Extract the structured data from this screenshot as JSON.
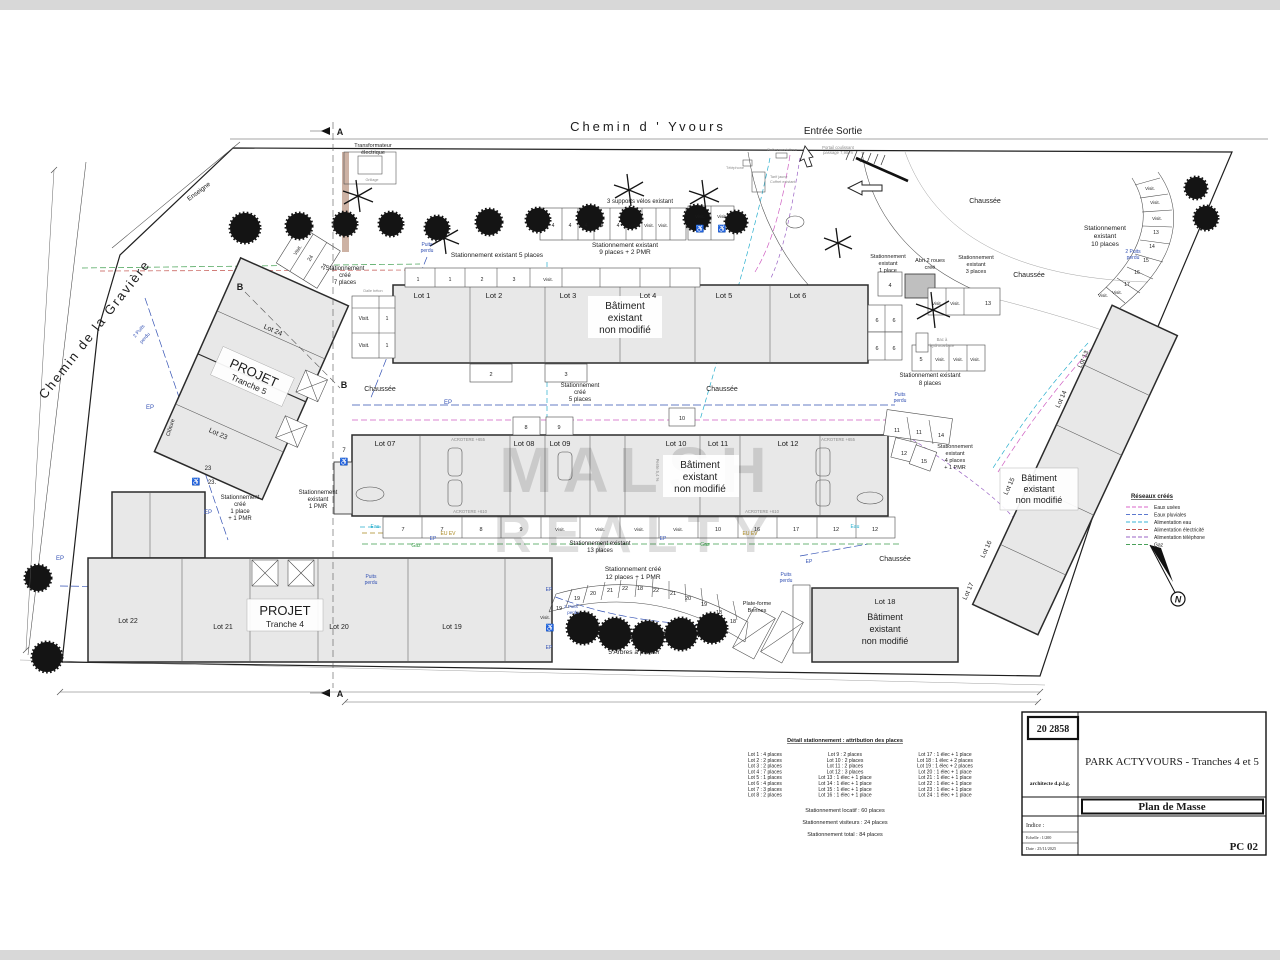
{
  "streets": {
    "top": "Chemin  d ' Yvours",
    "left": "Chemin de la Gravière"
  },
  "entrance": {
    "label": "Entrée Sortie",
    "gate1": "Portail coulissant",
    "gate2": "passage 7,90 m"
  },
  "transformer": {
    "l1": "Transformateur",
    "l2": "électrique",
    "cage": "Grillage"
  },
  "sections": {
    "a": "A",
    "b": "B"
  },
  "north": {
    "label": "N"
  },
  "watermark": {
    "l1": "MALSH",
    "l2": "REALTY"
  },
  "legend": {
    "title": "Réseaux créés",
    "items": [
      {
        "label": "Eaux usées",
        "color": "#d966c9"
      },
      {
        "label": "Eaux pluviales",
        "color": "#5c79cf"
      },
      {
        "label": "Alimentation eau",
        "color": "#38b3d6"
      },
      {
        "label": "Alimentation électricité",
        "color": "#c2524c"
      },
      {
        "label": "Alimentation téléphone",
        "color": "#9a63c4"
      },
      {
        "label": "Gaz",
        "color": "#4aa05a"
      }
    ]
  },
  "buildings": {
    "b1": {
      "l1": "Bâtiment",
      "l2": "existant",
      "l3": "non modifié",
      "lots": [
        "Lot 1",
        "Lot 2",
        "Lot 3",
        "Lot 4",
        "Lot 5",
        "Lot 6"
      ]
    },
    "b2": {
      "l1": "Bâtiment",
      "l2": "existant",
      "l3": "non modifié",
      "lots": [
        "Lot 07",
        "Lot 08",
        "Lot 09",
        "Lot 10",
        "Lot 11",
        "Lot 12"
      ]
    },
    "b3": {
      "l1": "Bâtiment",
      "l2": "existant",
      "l3": "non modifié",
      "lots": [
        "Lot 13",
        "Lot 14",
        "Lot 15",
        "Lot 16",
        "Lot 17"
      ]
    },
    "lot18": {
      "lot": "Lot 18",
      "l1": "Bâtiment",
      "l2": "existant",
      "l3": "non modifié"
    },
    "t5": {
      "name": "PROJET",
      "tranche": "Tranche 5",
      "lots": [
        "Lot 24",
        "Lot 23"
      ]
    },
    "t4": {
      "name": "PROJET",
      "tranche": "Tranche 4",
      "lots": [
        "Lot 22",
        "Lot 21",
        "Lot 20",
        "Lot 19"
      ]
    }
  },
  "parking": {
    "ex9": [
      "Stationnement existant",
      "9 places + 2 PMR"
    ],
    "ex5": "Stationnement existant  5 places",
    "cr7": [
      "Stationnement",
      "créé",
      "7 places"
    ],
    "cr5": [
      "Stationnement",
      "créé",
      "5 places"
    ],
    "ex13": [
      "Stationnement existant",
      "13 places"
    ],
    "cr12": [
      "Stationnement créé",
      "12 places + 1 PMR"
    ],
    "ex10": [
      "Stationnement",
      "existant",
      "10 places"
    ],
    "ex8": [
      "Stationnement existant",
      "8 places"
    ],
    "ex4": [
      "Stationnement",
      "existant",
      "4 places",
      "+ 1 PMR"
    ],
    "ex1": [
      "Stationnement",
      "existant",
      "1 place"
    ],
    "ex3": [
      "Stationnement",
      "existant",
      "3 places"
    ],
    "cr1": [
      "Stationnement",
      "créé",
      "1 place",
      "+ 1 PMR"
    ],
    "expmr": [
      "Stationnement",
      "existant",
      "1 PMR"
    ]
  },
  "features": {
    "abri": [
      "Abri 2 roues",
      "créé"
    ],
    "bac": [
      "Bac à",
      "hydrocarbure"
    ],
    "bennes": [
      "Plate-forme",
      "Bennes"
    ],
    "arbres": "5 Arbres à planter",
    "velos": "3 supports vélos existant",
    "chaussee": "Chaussée",
    "cloture": "Clôture",
    "enseigne": "Enseigne",
    "dalle": "Dalle béton",
    "pente": "Pente 5,4 %",
    "telephone": "Téléphone",
    "lettres": "Boîtes aux lettres",
    "coffret1": "Tarif jaune",
    "coffret2": "Coffret existant"
  },
  "utilities": {
    "ep": "EP",
    "eau": "Eau",
    "gaz": "Gaz",
    "euev": "EU EV",
    "puits1": "Puits",
    "puits2": "perdu",
    "p2a": "2 Puits",
    "acro655": "ACROTERE +655",
    "acro610": "ACROTERE +610"
  },
  "stalls": {
    "toprow": [
      "4",
      "4",
      "4",
      "4",
      "4",
      "Visit.",
      "Visit.",
      "Visit."
    ],
    "toppmr": [
      "Visit.",
      "Visit."
    ],
    "b1row": [
      "1",
      "1",
      "2",
      "3",
      "Visit."
    ],
    "b1below": [
      "2",
      "3"
    ],
    "vtable": [
      "Visit.",
      "1",
      "Visit.",
      "1"
    ],
    "left24": [
      "Visit.",
      "24",
      "24"
    ],
    "n23": [
      "23",
      "23."
    ],
    "n7": "7",
    "midrow": [
      "7",
      "7",
      "8",
      "9",
      "Visit.",
      "Visit.",
      "Visit.",
      "Visit.",
      "10",
      "16",
      "17",
      "12",
      "12"
    ],
    "midtop": [
      "8",
      "9",
      "10",
      "11",
      "11",
      "14",
      "12",
      "15"
    ],
    "rb": {
      "n4": "4",
      "six": [
        "6",
        "6",
        "6",
        "6"
      ],
      "five": "5",
      "v3": [
        "Visit.",
        "Visit.",
        "Visit."
      ],
      "n13": "13",
      "v2": [
        "Visit.",
        "Visit."
      ]
    },
    "arct": [
      "Visit.",
      "Visit.",
      "Visit.",
      "13",
      "14",
      "15",
      "16",
      "17",
      "Visit.",
      "Visit."
    ],
    "arcb": [
      "19",
      "19",
      "20",
      "21",
      "22",
      "18",
      "22",
      "21",
      "20",
      "19",
      "18",
      "18"
    ],
    "visit1": "Visit.",
    "pmr": "♿"
  },
  "detail": {
    "title": "Détail stationnement : attribution des places",
    "col1": [
      "Lot 1 : 4 places",
      "Lot 2 : 2 places",
      "Lot 3 : 2 places",
      "Lot 4 : 7 places",
      "Lot 5 : 1 places",
      "Lot 6 : 4 places",
      "Lot 7 : 3 places",
      "Lot 8 : 2 places"
    ],
    "col2": [
      "Lot 9 : 2 places",
      "Lot 10 : 2 places",
      "Lot 11 : 2 places",
      "Lot 12 : 3 places",
      "Lot 13 : 1 élec + 1 place",
      "Lot 14 : 1 élec + 1 place",
      "Lot 15 : 1 élec + 1 place",
      "Lot 16 : 1 élec + 1 place"
    ],
    "col3": [
      "Lot 17 : 1 élec + 1 place",
      "Lot 18 : 1 élec + 2 places",
      "Lot 19 : 1 élec + 2 places",
      "Lot 20 : 1 élec + 1 place",
      "Lot 21 : 1 élec + 1 place",
      "Lot 22 : 1 élec + 1 place",
      "Lot 23 : 1 élec + 1 place",
      "Lot 24 : 1 élec + 1 place"
    ],
    "summary": [
      "Stationnement locatif : 60 places",
      "Stationnement visiteurs : 24 places",
      "Stationnement total : 84 places"
    ]
  },
  "title_block": {
    "number": "20 2858",
    "architect": "architecte d.p.l.g.",
    "project": "PARK  ACTYVOURS - Tranches 4 et 5",
    "doc": "Plan de Masse",
    "indice": "Indice :",
    "echelle": "Echelle :  1/200",
    "date": "Date :  25/11/2025",
    "code": "PC 02"
  }
}
